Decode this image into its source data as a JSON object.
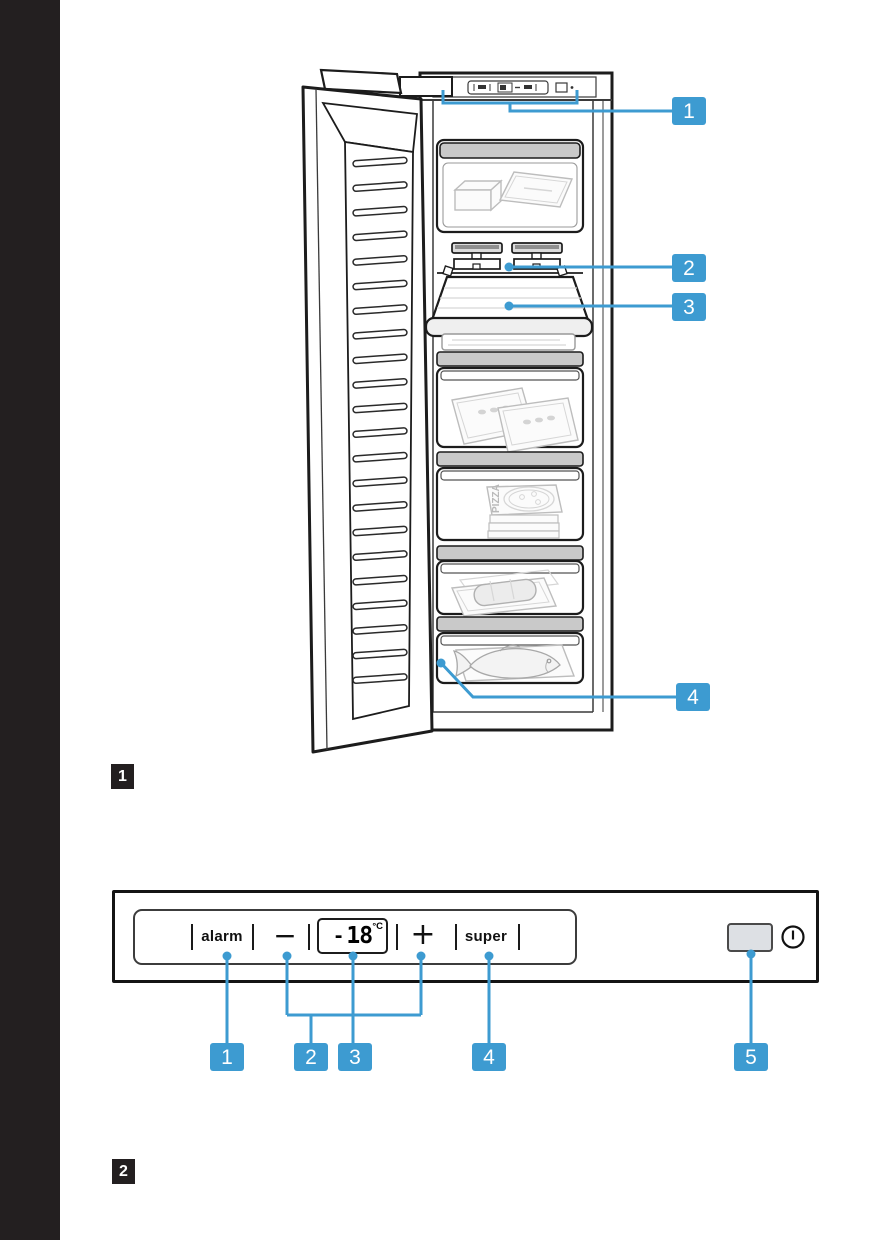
{
  "colors": {
    "accent_blue": "#3d9bd1",
    "figure_label_bg": "#231f20",
    "left_band": "#231f20",
    "rail_gray": "#c9c9c9"
  },
  "figure1": {
    "label": "1",
    "callouts": [
      "1",
      "2",
      "3",
      "4"
    ],
    "pizza_label": "PIZZA"
  },
  "figure2": {
    "label": "2",
    "callouts": [
      "1",
      "2",
      "3",
      "4",
      "5"
    ],
    "panel": {
      "alarm": "alarm",
      "minus": "−",
      "plus": "+",
      "super": "super",
      "display": {
        "sign": "-",
        "value": "18",
        "unit": "°C"
      }
    }
  }
}
